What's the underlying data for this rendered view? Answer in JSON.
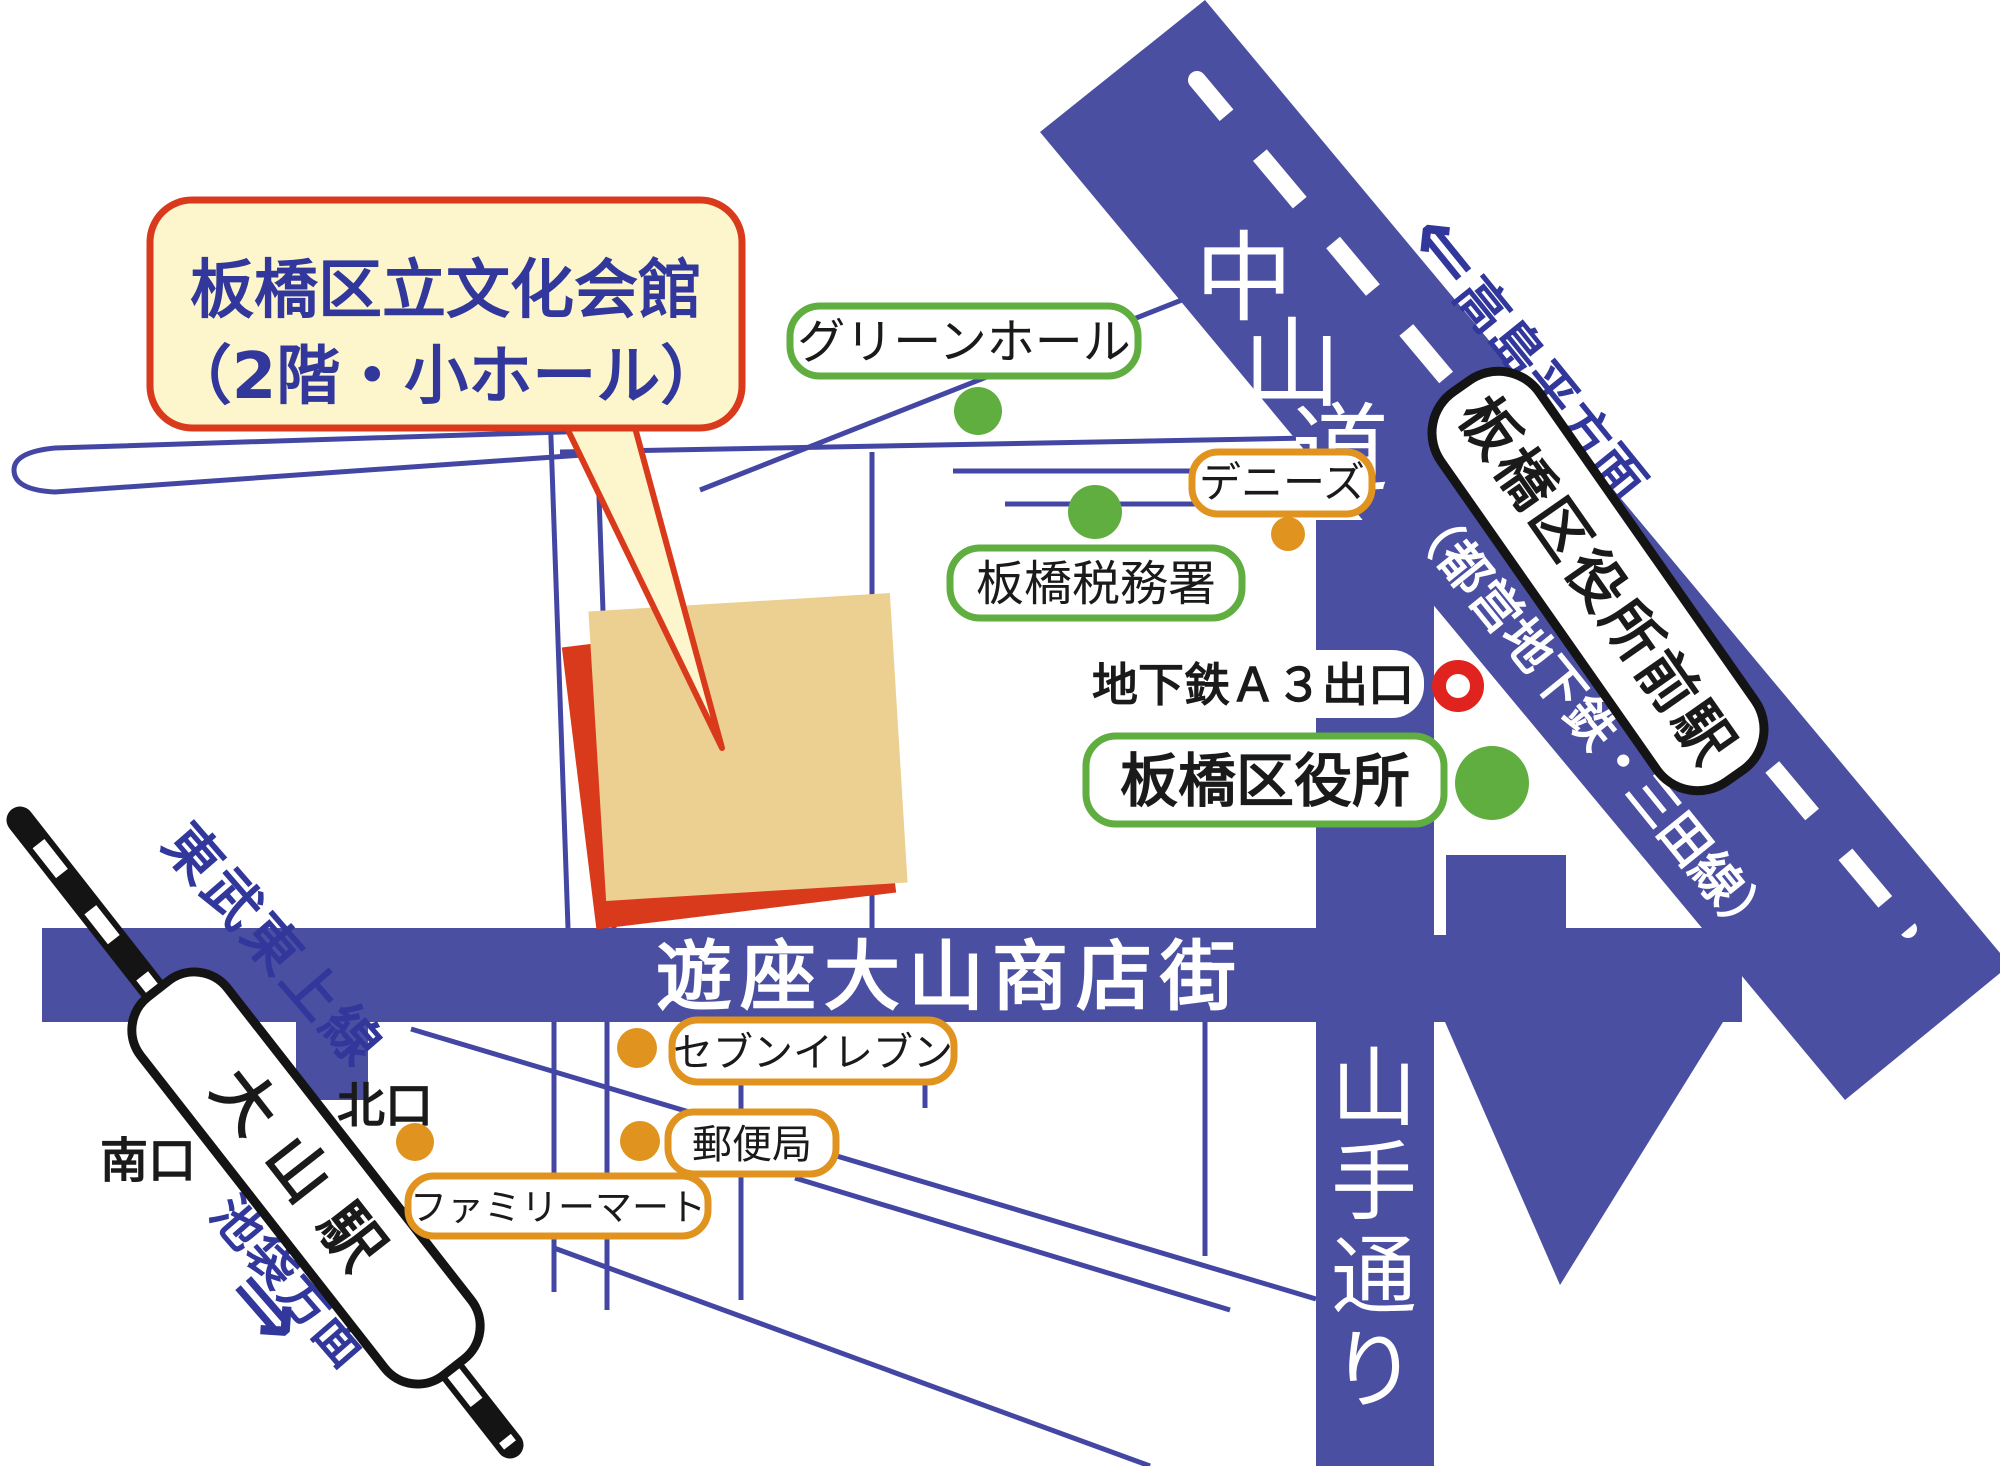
{
  "map_title": "板橋区立文化会館 案内図",
  "callout": {
    "line1": "板橋区立文化会館",
    "line2": "（2階・小ホール）"
  },
  "roads": {
    "nakasendo": {
      "name": "中山道",
      "chars": [
        "中",
        "山",
        "道"
      ]
    },
    "yamate_dori": {
      "name": "山手通り",
      "chars": [
        "山",
        "手",
        "通",
        "り"
      ]
    },
    "shopping_street": {
      "name": "遊座大山商店街"
    }
  },
  "railways": {
    "tobu_tojo_line": "東武東上線",
    "mita_line_note": "（都営地下鉄・三田線）",
    "station_kuyakushomae": "板橋区役所前駅",
    "station_oyama": "大山駅",
    "north_exit": "北口",
    "south_exit": "南口",
    "ikebukuro_direction": "池袋方面",
    "ikebukuro_arrow": "⇒",
    "takashimadaira_direction": "高島平方面",
    "takashimadaira_arrow": "⇐"
  },
  "pois": {
    "green_hall": "グリーンホール",
    "tax_office": "板橋税務署",
    "dennys": "デニーズ",
    "ward_office": "板橋区役所",
    "subway_exit": "地下鉄Ａ３出口",
    "seven_eleven": "セブンイレブン",
    "post_office": "郵便局",
    "family_mart": "ファミリーマート"
  },
  "colors": {
    "road_blue": "#4a4fa2",
    "minor_road_blue": "#4347a3",
    "text_blue": "#31379b",
    "green": "#5fae3f",
    "orange": "#e0941f",
    "red": "#da3a1c",
    "subway_exit_red": "#e0231e",
    "callout_cream": "#fdf5cc",
    "building_tan": "#ecd092",
    "rail_black": "#141414"
  }
}
